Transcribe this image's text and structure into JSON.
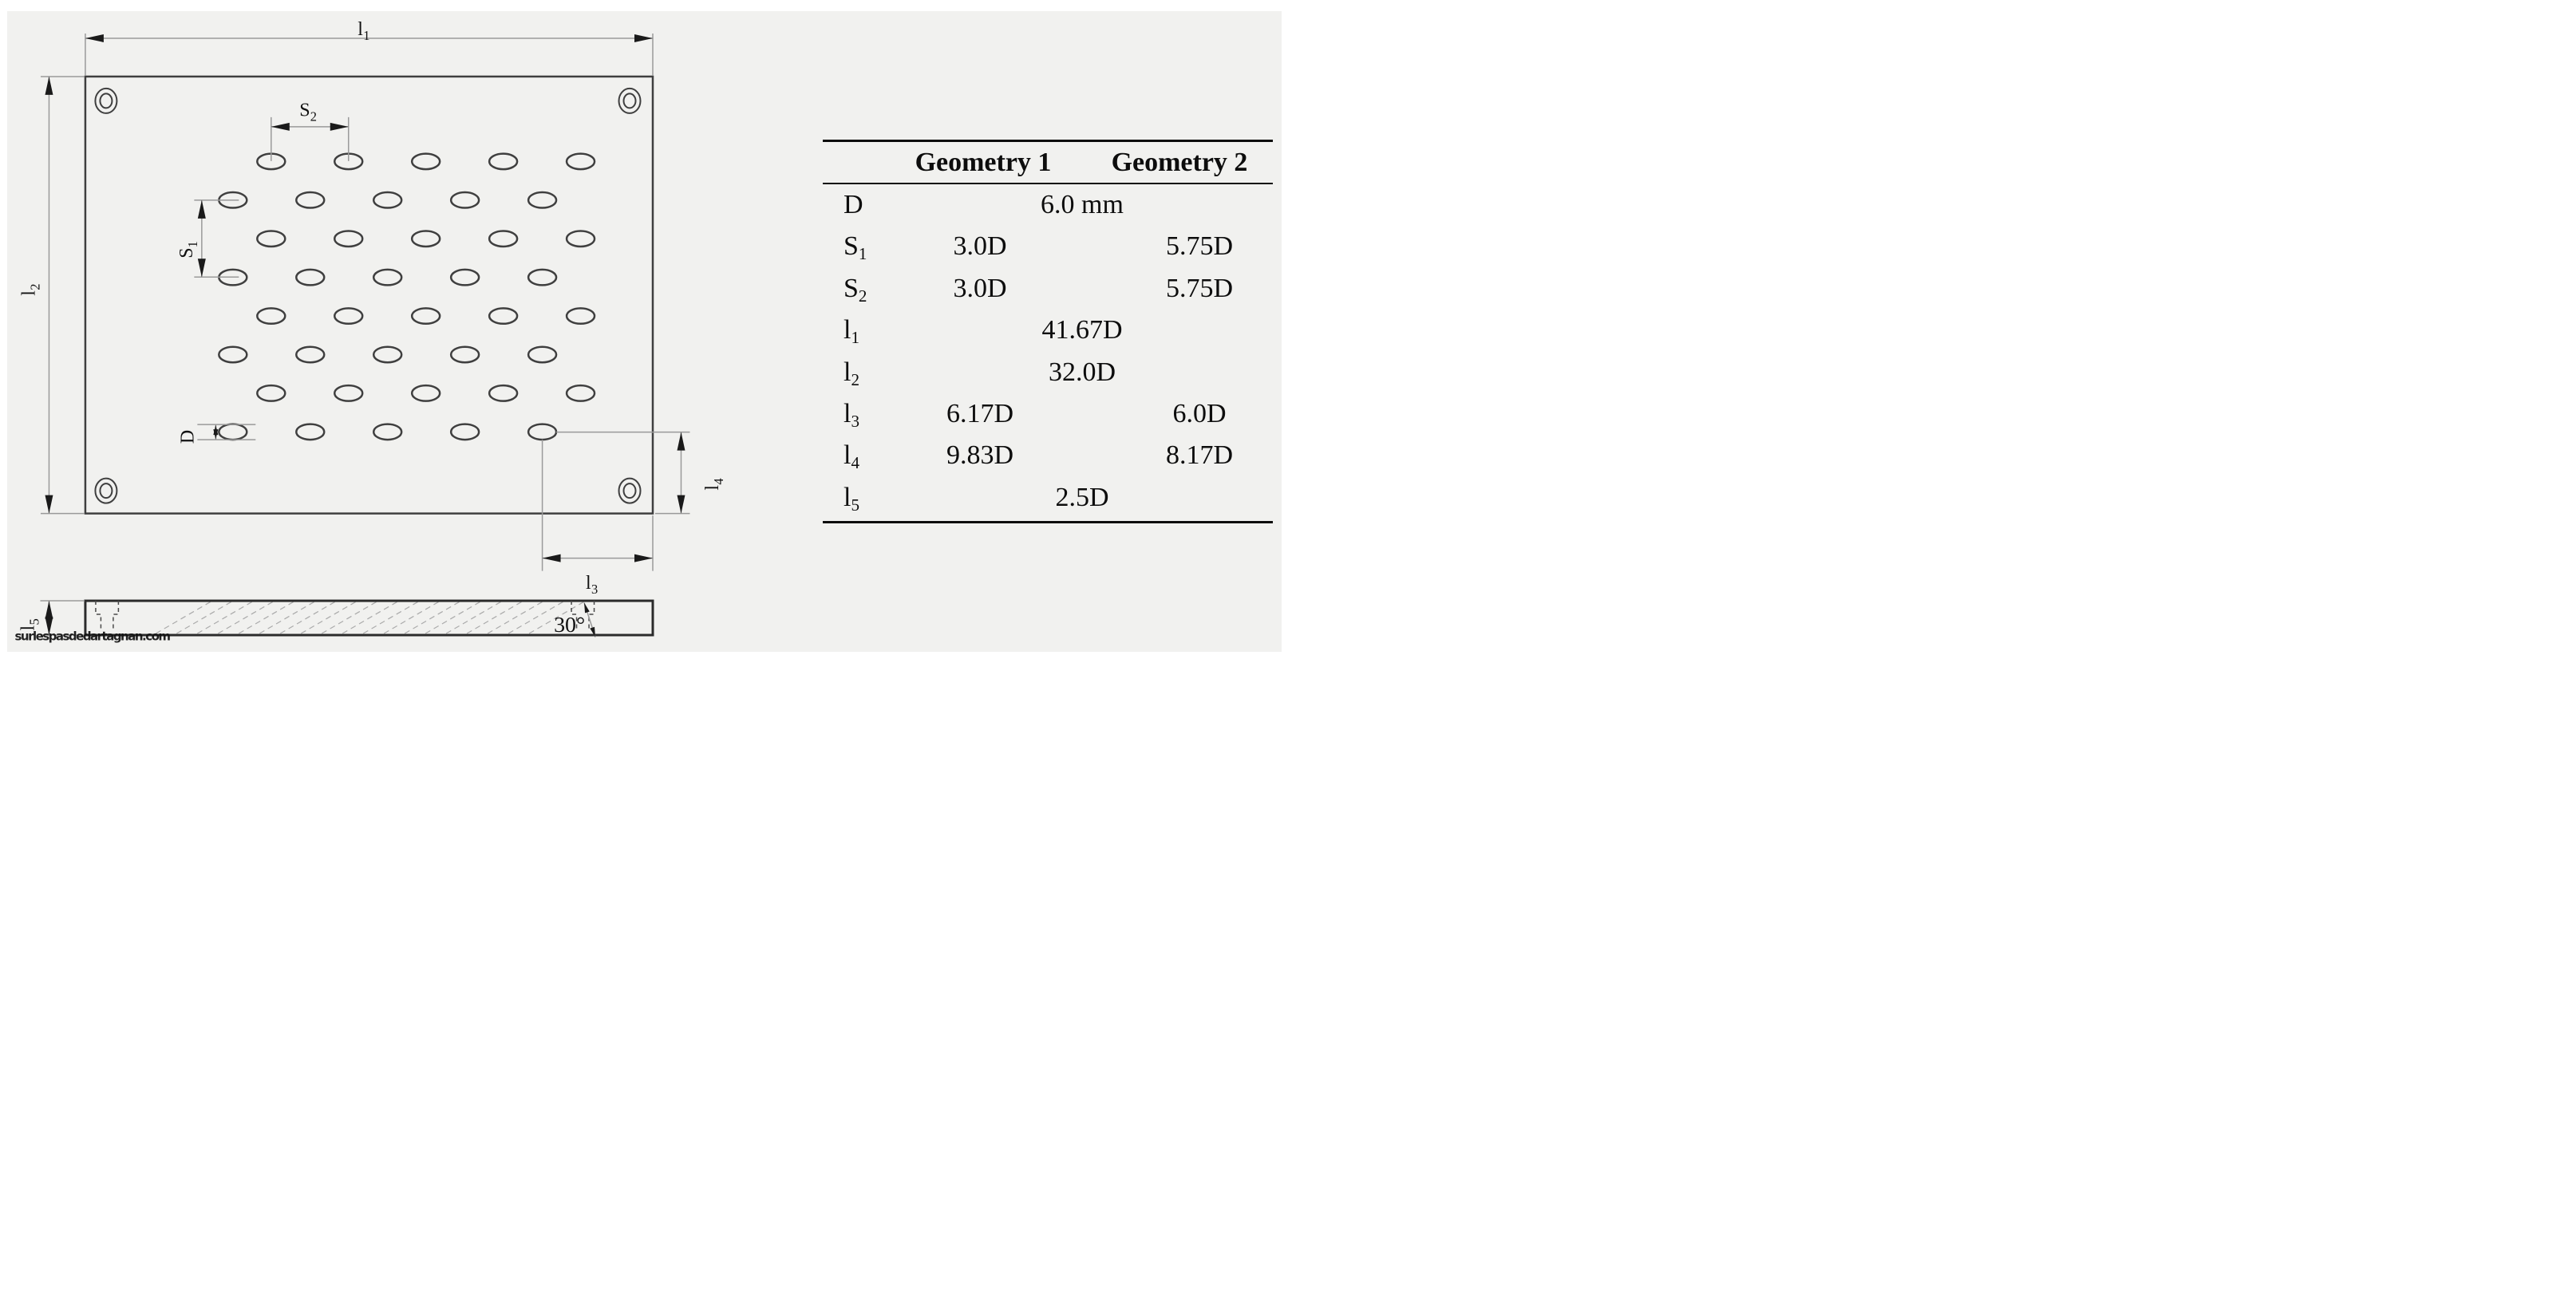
{
  "watermark": {
    "text": "surlespasdedartagnan.com",
    "color": "#2e9f82"
  },
  "figure": {
    "description": "perforated-plate engineering drawing",
    "hole_rows": 8,
    "holes_per_row": 5,
    "corner_holes": 4
  },
  "drawing": {
    "labels": {
      "l1": {
        "main": "l",
        "sub": "1"
      },
      "l2": {
        "main": "l",
        "sub": "2"
      },
      "l3": {
        "main": "l",
        "sub": "3"
      },
      "l4": {
        "main": "l",
        "sub": "4"
      },
      "l5": {
        "main": "l",
        "sub": "5"
      },
      "s1": {
        "main": "S",
        "sub": "1"
      },
      "s2": {
        "main": "S",
        "sub": "2"
      },
      "d": {
        "main": "D"
      },
      "angle": "30°"
    }
  },
  "table": {
    "headers": {
      "col1": "Geometry 1",
      "col2": "Geometry 2"
    },
    "rows": [
      {
        "label": "D",
        "sub": "",
        "g1": "",
        "g2": "",
        "span": "6.0 mm"
      },
      {
        "label": "S",
        "sub": "1",
        "g1": "3.0D",
        "g2": "5.75D",
        "span": ""
      },
      {
        "label": "S",
        "sub": "2",
        "g1": "3.0D",
        "g2": "5.75D",
        "span": ""
      },
      {
        "label": "l",
        "sub": "1",
        "g1": "",
        "g2": "",
        "span": "41.67D"
      },
      {
        "label": "l",
        "sub": "2",
        "g1": "",
        "g2": "",
        "span": "32.0D"
      },
      {
        "label": "l",
        "sub": "3",
        "g1": "6.17D",
        "g2": "6.0D",
        "span": ""
      },
      {
        "label": "l",
        "sub": "4",
        "g1": "9.83D",
        "g2": "8.17D",
        "span": ""
      },
      {
        "label": "l",
        "sub": "5",
        "g1": "",
        "g2": "",
        "span": "2.5D"
      }
    ]
  }
}
